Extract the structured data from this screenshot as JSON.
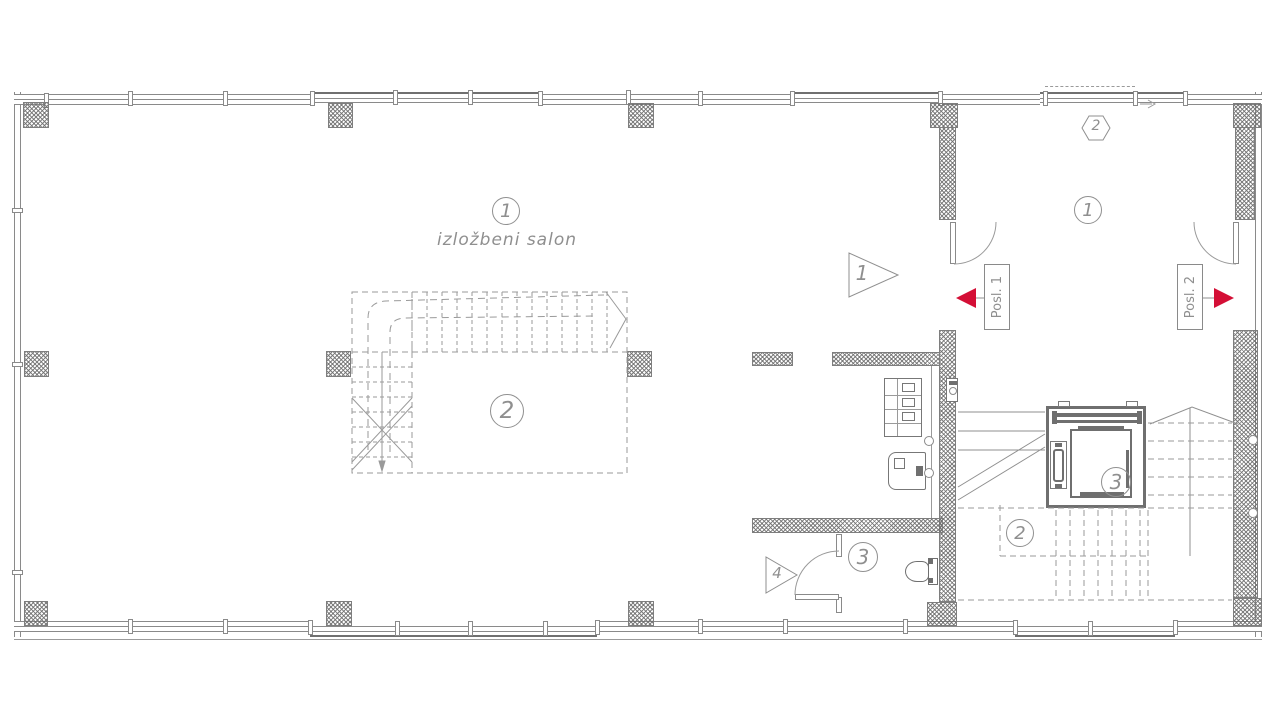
{
  "plan": {
    "colors": {
      "line": "#8a8a8a",
      "dark": "#6f6f6f",
      "accent_red": "#d40f36"
    },
    "salon": {
      "number": "1",
      "name": "izložbeni salon",
      "stair_number": "2"
    },
    "wc": {
      "number": "3"
    },
    "lobby": {
      "number": "1",
      "grid_marker": "2"
    },
    "stairwell": {
      "number": "2"
    },
    "elevator": {
      "number": "3"
    },
    "entrances": {
      "pos1": {
        "label": "Posl. 1"
      },
      "pos2": {
        "label": "Posl. 2"
      }
    },
    "section_markers": {
      "m1": "1",
      "m4": "4"
    }
  }
}
